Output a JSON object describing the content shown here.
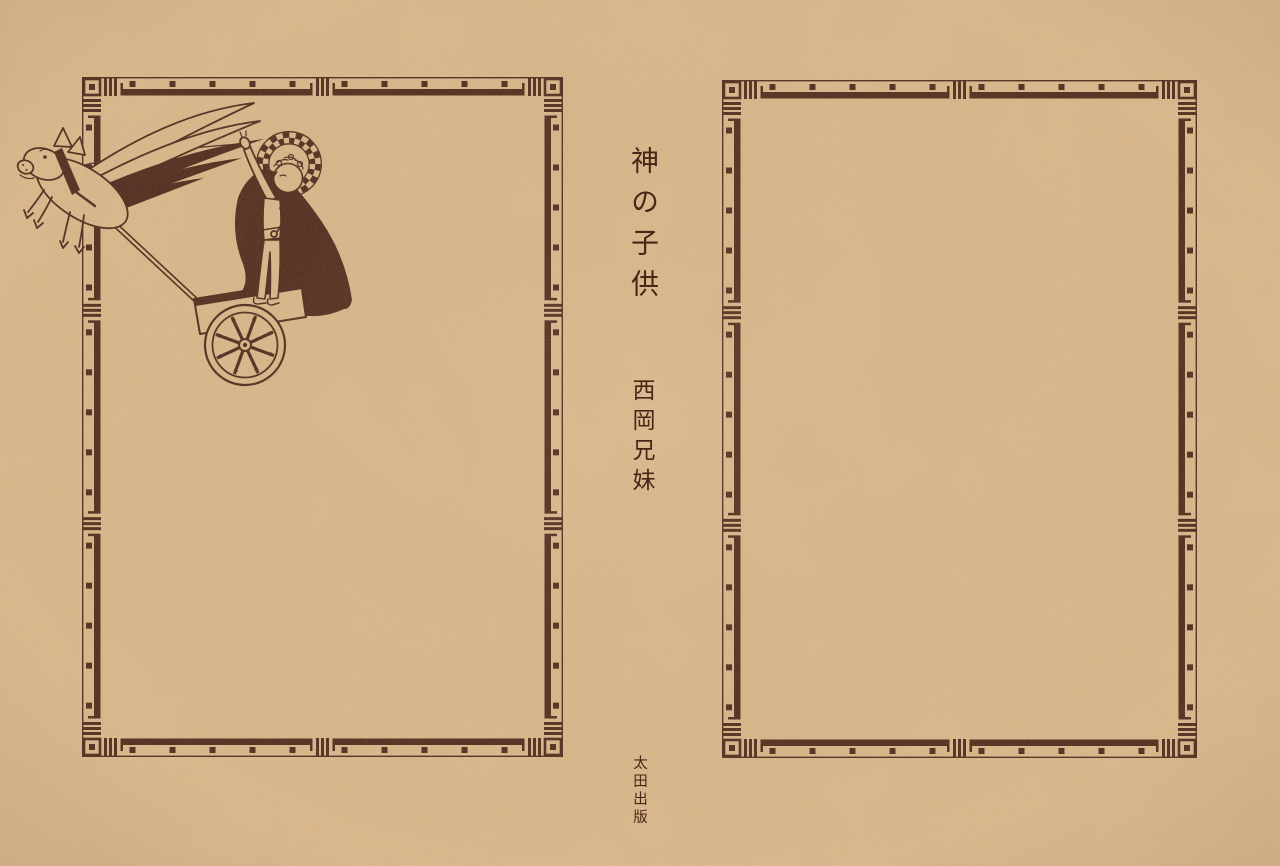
{
  "colors": {
    "paper": "#dcb98c",
    "ink": "#4b2418"
  },
  "spine": {
    "title": "神の子供",
    "author": "西岡兄妹"
  },
  "imprint": {
    "publisher": "太田出版"
  },
  "illustration": {
    "alt": "Haloed child riding a two-wheeled chariot drawn by a winged pig"
  }
}
